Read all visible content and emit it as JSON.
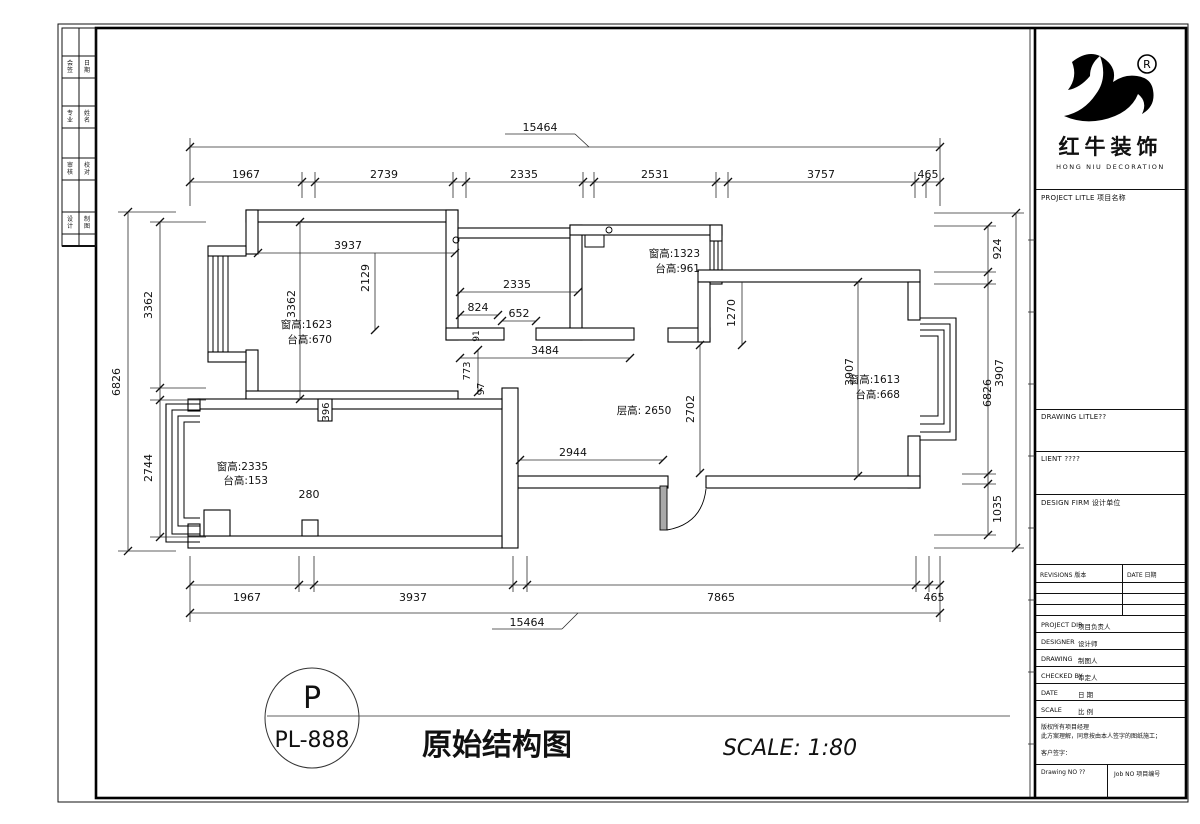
{
  "drawing": {
    "legend_circle_top": "P",
    "legend_circle_bottom": "PL-888",
    "title": "原始结构图",
    "scale_note": "SCALE: 1:80"
  },
  "titleblock": {
    "brand_cn": "红牛装饰",
    "brand_en": "HONG NIU DECORATION",
    "reg_mark": "R",
    "project_label": "PROJECT LITLE 项目名称",
    "drawing_label": "DRAWING LITLE??",
    "client_label": "LIENT ????",
    "firm_label": "DESIGN FIRM 设计单位",
    "revisions_label": "REVISIONS 版本",
    "revisions_date_label": "DATE 日期",
    "rows": [
      {
        "en": "PROJECT DIR",
        "cn": "项目负责人"
      },
      {
        "en": "DESIGNER",
        "cn": "设计师"
      },
      {
        "en": "DRAWING",
        "cn": "制图人"
      },
      {
        "en": "CHECKED BY",
        "cn": "审定人"
      },
      {
        "en": "DATE",
        "cn": "日 期"
      },
      {
        "en": "SCALE",
        "cn": "比 例"
      }
    ],
    "note_line1": "版权所有项目经理",
    "note_line2": "此方案理解，同意按由本人签字的图纸施工；",
    "note_line3": "客户签字：",
    "drawing_no_label": "Drawing NO ??",
    "job_no_label": "Job NO 项目编号"
  },
  "plan": {
    "walls": [
      [
        246,
        210,
        212,
        12
      ],
      [
        246,
        210,
        12,
        44
      ],
      [
        246,
        350,
        12,
        52
      ],
      [
        246,
        391,
        212,
        11
      ],
      [
        208,
        246,
        38,
        10
      ],
      [
        208,
        352,
        38,
        10
      ],
      [
        446,
        210,
        12,
        130
      ],
      [
        458,
        228,
        122,
        10
      ],
      [
        570,
        225,
        12,
        115
      ],
      [
        570,
        225,
        152,
        10
      ],
      [
        446,
        328,
        58,
        12
      ],
      [
        536,
        328,
        98,
        12
      ],
      [
        668,
        328,
        42,
        14
      ],
      [
        710,
        225,
        12,
        16
      ],
      [
        710,
        270,
        12,
        14
      ],
      [
        698,
        270,
        222,
        12
      ],
      [
        698,
        282,
        12,
        60
      ],
      [
        908,
        282,
        12,
        38
      ],
      [
        908,
        436,
        12,
        52
      ],
      [
        706,
        476,
        214,
        12
      ],
      [
        518,
        476,
        150,
        12
      ],
      [
        502,
        388,
        16,
        160
      ],
      [
        198,
        399,
        304,
        10
      ],
      [
        188,
        536,
        314,
        12
      ],
      [
        188,
        399,
        12,
        12
      ],
      [
        188,
        524,
        12,
        12
      ],
      [
        318,
        399,
        14,
        22
      ],
      [
        204,
        510,
        26,
        26
      ],
      [
        302,
        520,
        16,
        16
      ]
    ],
    "gray_rects": [
      [
        660,
        486,
        7,
        44
      ]
    ],
    "window_lines": [
      [
        208,
        246,
        208,
        362
      ],
      [
        213,
        256,
        213,
        352
      ],
      [
        218,
        256,
        218,
        352
      ],
      [
        223,
        256,
        223,
        352
      ],
      [
        228,
        256,
        228,
        352
      ],
      [
        710,
        241,
        710,
        270
      ],
      [
        714,
        241,
        714,
        270
      ],
      [
        718,
        241,
        718,
        270
      ],
      [
        722,
        241,
        722,
        270
      ],
      [
        710,
        241,
        722,
        241
      ],
      [
        710,
        270,
        722,
        270
      ]
    ],
    "paths": [
      {
        "d": "M920,318 L956,318 L956,440 L920,440",
        "w": 1.1
      },
      {
        "d": "M920,324 L950,324 L950,432 L920,432",
        "w": 1.0
      },
      {
        "d": "M920,330 L944,330 L944,424 L920,424",
        "w": 1.0
      },
      {
        "d": "M920,336 L938,336 L938,416 L920,416",
        "w": 1.0
      },
      {
        "d": "M200,404 L166,404 L166,542 L200,542",
        "w": 1.1
      },
      {
        "d": "M200,410 L172,410 L172,534 L200,534",
        "w": 1.0
      },
      {
        "d": "M200,416 L178,416 L178,526 L200,526",
        "w": 1.0
      },
      {
        "d": "M200,422 L184,422 L184,518 L200,518",
        "w": 1.0
      },
      {
        "d": "M585,235 L585,247 L604,247 L604,235",
        "w": 1.0
      },
      {
        "d": "M667,530 Q702,524 706,489",
        "w": 0.9
      }
    ],
    "circles": [
      [
        456,
        240,
        3
      ],
      [
        609,
        230,
        3
      ]
    ],
    "ellipses": [
      [
        312,
        718,
        47,
        50
      ]
    ],
    "dim_lines": [
      [
        190,
        147,
        940,
        147
      ],
      [
        505,
        134,
        575,
        134
      ],
      [
        575,
        134,
        589,
        147
      ],
      [
        190,
        138,
        190,
        206
      ],
      [
        940,
        138,
        940,
        206
      ],
      [
        190,
        182,
        940,
        182
      ],
      [
        302,
        172,
        302,
        198
      ],
      [
        315,
        172,
        315,
        198
      ],
      [
        453,
        172,
        453,
        198
      ],
      [
        466,
        172,
        466,
        198
      ],
      [
        583,
        172,
        583,
        198
      ],
      [
        594,
        172,
        594,
        198
      ],
      [
        716,
        172,
        716,
        198
      ],
      [
        728,
        172,
        728,
        198
      ],
      [
        915,
        172,
        915,
        198
      ],
      [
        926,
        172,
        926,
        198
      ],
      [
        190,
        585,
        940,
        585
      ],
      [
        299,
        556,
        299,
        592
      ],
      [
        314,
        556,
        314,
        592
      ],
      [
        513,
        556,
        513,
        592
      ],
      [
        527,
        556,
        527,
        592
      ],
      [
        916,
        556,
        916,
        592
      ],
      [
        929,
        556,
        929,
        592
      ],
      [
        190,
        556,
        190,
        622
      ],
      [
        940,
        556,
        940,
        622
      ],
      [
        190,
        613,
        940,
        613
      ],
      [
        492,
        629,
        562,
        629
      ],
      [
        562,
        629,
        578,
        613
      ],
      [
        128,
        212,
        128,
        551
      ],
      [
        118,
        212,
        176,
        212
      ],
      [
        118,
        551,
        176,
        551
      ],
      [
        160,
        222,
        160,
        537
      ],
      [
        150,
        222,
        206,
        222
      ],
      [
        150,
        388,
        206,
        388
      ],
      [
        150,
        400,
        206,
        400
      ],
      [
        150,
        537,
        206,
        537
      ],
      [
        988,
        226,
        988,
        535
      ],
      [
        934,
        226,
        996,
        226
      ],
      [
        934,
        272,
        996,
        272
      ],
      [
        934,
        284,
        996,
        284
      ],
      [
        962,
        474,
        996,
        474
      ],
      [
        962,
        484,
        996,
        484
      ],
      [
        934,
        535,
        996,
        535
      ],
      [
        1016,
        213,
        1016,
        548
      ],
      [
        934,
        213,
        1024,
        213
      ],
      [
        934,
        548,
        1024,
        548
      ],
      [
        258,
        253,
        455,
        253
      ],
      [
        375,
        253,
        375,
        330
      ],
      [
        300,
        222,
        300,
        399
      ],
      [
        460,
        292,
        578,
        292
      ],
      [
        460,
        315,
        498,
        315
      ],
      [
        502,
        321,
        536,
        321
      ],
      [
        460,
        358,
        630,
        358
      ],
      [
        478,
        350,
        478,
        392
      ],
      [
        742,
        282,
        742,
        345
      ],
      [
        858,
        282,
        858,
        476
      ],
      [
        700,
        345,
        700,
        473
      ],
      [
        520,
        460,
        663,
        460
      ],
      [
        267,
        716,
        1010,
        716
      ],
      [
        1028,
        240,
        1035,
        240
      ],
      [
        1028,
        312,
        1035,
        312
      ],
      [
        1028,
        384,
        1035,
        384
      ],
      [
        1028,
        456,
        1035,
        456
      ],
      [
        1028,
        528,
        1035,
        528
      ],
      [
        1028,
        600,
        1035,
        600
      ],
      [
        1028,
        672,
        1035,
        672
      ],
      [
        1028,
        744,
        1035,
        744
      ]
    ],
    "dim_ticks": [
      [
        190,
        147
      ],
      [
        940,
        147
      ],
      [
        190,
        182
      ],
      [
        302,
        182
      ],
      [
        315,
        182
      ],
      [
        453,
        182
      ],
      [
        466,
        182
      ],
      [
        583,
        182
      ],
      [
        594,
        182
      ],
      [
        716,
        182
      ],
      [
        728,
        182
      ],
      [
        915,
        182
      ],
      [
        926,
        182
      ],
      [
        940,
        182
      ],
      [
        190,
        585
      ],
      [
        299,
        585
      ],
      [
        314,
        585
      ],
      [
        513,
        585
      ],
      [
        527,
        585
      ],
      [
        916,
        585
      ],
      [
        929,
        585
      ],
      [
        940,
        585
      ],
      [
        190,
        613
      ],
      [
        940,
        613
      ],
      [
        128,
        212
      ],
      [
        128,
        551
      ],
      [
        160,
        222
      ],
      [
        160,
        388
      ],
      [
        160,
        400
      ],
      [
        160,
        537
      ],
      [
        988,
        226
      ],
      [
        988,
        272
      ],
      [
        988,
        284
      ],
      [
        988,
        474
      ],
      [
        988,
        484
      ],
      [
        988,
        535
      ],
      [
        1016,
        213
      ],
      [
        1016,
        548
      ],
      [
        258,
        253
      ],
      [
        455,
        253
      ],
      [
        375,
        330
      ],
      [
        300,
        222
      ],
      [
        300,
        399
      ],
      [
        460,
        292
      ],
      [
        578,
        292
      ],
      [
        460,
        315
      ],
      [
        498,
        315
      ],
      [
        502,
        321
      ],
      [
        536,
        321
      ],
      [
        460,
        358
      ],
      [
        630,
        358
      ],
      [
        478,
        350
      ],
      [
        478,
        392
      ],
      [
        742,
        345
      ],
      [
        858,
        282
      ],
      [
        858,
        476
      ],
      [
        700,
        345
      ],
      [
        700,
        473
      ],
      [
        520,
        460
      ],
      [
        663,
        460
      ]
    ],
    "labels": [
      {
        "t": "15464",
        "x": 540,
        "y": 131
      },
      {
        "t": "1967",
        "x": 246,
        "y": 178
      },
      {
        "t": "2739",
        "x": 384,
        "y": 178
      },
      {
        "t": "2335",
        "x": 524,
        "y": 178
      },
      {
        "t": "2531",
        "x": 655,
        "y": 178
      },
      {
        "t": "3757",
        "x": 821,
        "y": 178
      },
      {
        "t": "465",
        "x": 928,
        "y": 178
      },
      {
        "t": "1967",
        "x": 247,
        "y": 601
      },
      {
        "t": "3937",
        "x": 413,
        "y": 601
      },
      {
        "t": "7865",
        "x": 721,
        "y": 601
      },
      {
        "t": "465",
        "x": 934,
        "y": 601
      },
      {
        "t": "15464",
        "x": 527,
        "y": 626
      },
      {
        "t": "6826",
        "x": 120,
        "y": 382,
        "r": -90
      },
      {
        "t": "3362",
        "x": 152,
        "y": 305,
        "r": -90
      },
      {
        "t": "2744",
        "x": 152,
        "y": 468,
        "r": -90
      },
      {
        "t": "924",
        "x": 1001,
        "y": 249,
        "r": -90
      },
      {
        "t": "3907",
        "x": 1003,
        "y": 373,
        "r": -90
      },
      {
        "t": "6826",
        "x": 991,
        "y": 393,
        "r": -90
      },
      {
        "t": "1035",
        "x": 1001,
        "y": 509,
        "r": -90
      },
      {
        "t": "3937",
        "x": 348,
        "y": 249
      },
      {
        "t": "2129",
        "x": 369,
        "y": 278,
        "r": -90
      },
      {
        "t": "3362",
        "x": 295,
        "y": 304,
        "r": -90
      },
      {
        "t": "2335",
        "x": 517,
        "y": 288
      },
      {
        "t": "824",
        "x": 478,
        "y": 311
      },
      {
        "t": "652",
        "x": 519,
        "y": 317
      },
      {
        "t": "91",
        "x": 479,
        "y": 336,
        "r": -90,
        "s": 9
      },
      {
        "t": "3484",
        "x": 545,
        "y": 354
      },
      {
        "t": "773",
        "x": 470,
        "y": 371,
        "r": -90,
        "s": 10
      },
      {
        "t": "97",
        "x": 484,
        "y": 389,
        "r": -90,
        "s": 10
      },
      {
        "t": "1270",
        "x": 735,
        "y": 313,
        "r": -90
      },
      {
        "t": "3907",
        "x": 853,
        "y": 372,
        "r": -90
      },
      {
        "t": "2702",
        "x": 694,
        "y": 409,
        "r": -90
      },
      {
        "t": "2944",
        "x": 573,
        "y": 456
      },
      {
        "t": "280",
        "x": 309,
        "y": 498
      },
      {
        "t": "396",
        "x": 329,
        "y": 412,
        "r": -90,
        "s": 10
      },
      {
        "t": "窗高:1623",
        "x": 332,
        "y": 328,
        "a": "end",
        "s": 10.5
      },
      {
        "t": "台高:670",
        "x": 332,
        "y": 343,
        "a": "end",
        "s": 10.5
      },
      {
        "t": "窗高:1323",
        "x": 700,
        "y": 257,
        "a": "end",
        "s": 10.5
      },
      {
        "t": "台高:961",
        "x": 700,
        "y": 272,
        "a": "end",
        "s": 10.5
      },
      {
        "t": "窗高:1613",
        "x": 900,
        "y": 383,
        "a": "end",
        "s": 10.5
      },
      {
        "t": "台高:668",
        "x": 900,
        "y": 398,
        "a": "end",
        "s": 10.5
      },
      {
        "t": "窗高:2335",
        "x": 268,
        "y": 470,
        "a": "end",
        "s": 10.5
      },
      {
        "t": "台高:153",
        "x": 268,
        "y": 484,
        "a": "end",
        "s": 10.5
      },
      {
        "t": "层高: 2650",
        "x": 644,
        "y": 414,
        "s": 10.5
      },
      {
        "t": "P",
        "x": 312,
        "y": 708,
        "s": 30
      },
      {
        "t": "PL-888",
        "x": 312,
        "y": 747,
        "s": 22
      },
      {
        "t": "原始结构图",
        "x": 497,
        "y": 755,
        "s": 30,
        "b": 1
      },
      {
        "t": "SCALE: 1:80",
        "x": 790,
        "y": 755,
        "s": 22,
        "i": 1
      },
      {
        "t": "会",
        "x": 70,
        "y": 65,
        "s": 6
      },
      {
        "t": "签",
        "x": 70,
        "y": 72,
        "s": 6
      },
      {
        "t": "日",
        "x": 87,
        "y": 65,
        "s": 6
      },
      {
        "t": "期",
        "x": 87,
        "y": 72,
        "s": 6
      },
      {
        "t": "专",
        "x": 70,
        "y": 115,
        "s": 6
      },
      {
        "t": "业",
        "x": 70,
        "y": 122,
        "s": 6
      },
      {
        "t": "姓",
        "x": 87,
        "y": 115,
        "s": 6
      },
      {
        "t": "名",
        "x": 87,
        "y": 122,
        "s": 6
      },
      {
        "t": "审",
        "x": 70,
        "y": 167,
        "s": 6
      },
      {
        "t": "核",
        "x": 70,
        "y": 174,
        "s": 6
      },
      {
        "t": "校",
        "x": 87,
        "y": 167,
        "s": 6
      },
      {
        "t": "对",
        "x": 87,
        "y": 174,
        "s": 6
      },
      {
        "t": "设",
        "x": 70,
        "y": 221,
        "s": 6
      },
      {
        "t": "计",
        "x": 70,
        "y": 228,
        "s": 6
      },
      {
        "t": "制",
        "x": 87,
        "y": 221,
        "s": 6
      },
      {
        "t": "图",
        "x": 87,
        "y": 228,
        "s": 6
      }
    ]
  }
}
